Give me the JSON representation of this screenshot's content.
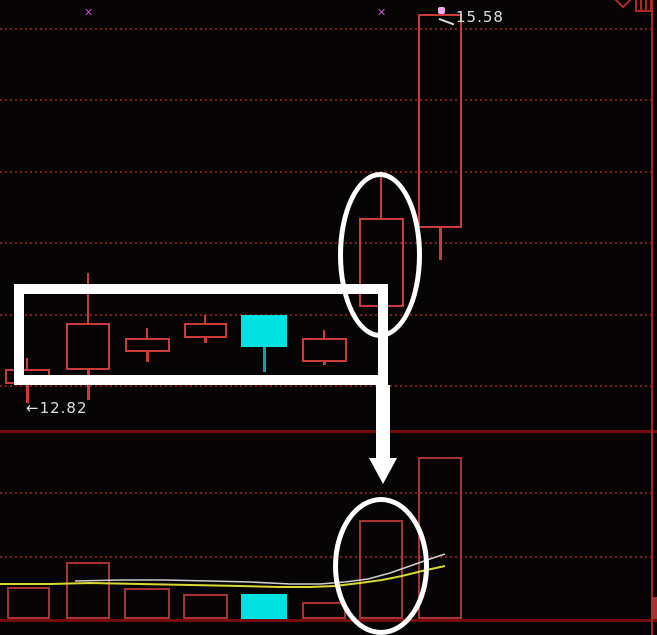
{
  "window": {
    "width": 657,
    "height": 635
  },
  "colors": {
    "background": "#060404",
    "candle_red": "#cd3a3a",
    "volume_red": "#a83232",
    "cyan": "#00e2e2",
    "cyan_wick": "#00a8a8",
    "gridline": "#7c1e1e",
    "divider": "#740c0c",
    "border": "#a82222",
    "ma_yellow": "#d8d835",
    "ma_white": "#cfcfcf",
    "annotation_white": "#ffffff",
    "marker_magenta": "#c94fc9",
    "marker_dot": "#e9aee9",
    "label_text": "#dedede"
  },
  "labels": {
    "high_price": "15.58",
    "low_arrow": "←",
    "low_price": "12.82"
  },
  "header": {
    "icons": [
      {
        "name": "diamond-icon"
      },
      {
        "name": "panel-icon"
      }
    ]
  },
  "chart_data": {
    "type": "candlestick_with_volume",
    "title": "",
    "annotated_high": 15.58,
    "annotated_low": 12.82,
    "panes": [
      "price",
      "volume"
    ],
    "grid": "dotted-horizontal",
    "gridlines_price_y": [
      28,
      99,
      171,
      242,
      314,
      385
    ],
    "gridlines_volume_y": [
      492,
      556
    ],
    "divider_y": 430,
    "baseline_y": 619,
    "right_border_x": 651,
    "candles": [
      {
        "x": 5,
        "w": 45,
        "body_top": 369,
        "body_bot": 384,
        "wick_top": 358,
        "wick_bot": 403,
        "fill": "hollow"
      },
      {
        "x": 66,
        "w": 44,
        "body_top": 323,
        "body_bot": 370,
        "wick_top": 273,
        "wick_bot": 400,
        "fill": "hollow"
      },
      {
        "x": 125,
        "w": 45,
        "body_top": 338,
        "body_bot": 352,
        "wick_top": 328,
        "wick_bot": 362,
        "fill": "hollow"
      },
      {
        "x": 184,
        "w": 43,
        "body_top": 323,
        "body_bot": 338,
        "wick_top": 315,
        "wick_bot": 343,
        "fill": "hollow"
      },
      {
        "x": 241,
        "w": 46,
        "body_top": 315,
        "body_bot": 347,
        "wick_top": 315,
        "wick_bot": 372,
        "fill": "cyan"
      },
      {
        "x": 302,
        "w": 45,
        "body_top": 338,
        "body_bot": 362,
        "wick_top": 330,
        "wick_bot": 365,
        "fill": "hollow"
      },
      {
        "x": 359,
        "w": 45,
        "body_top": 218,
        "body_bot": 307,
        "wick_top": 173,
        "wick_bot": 307,
        "fill": "hollow"
      },
      {
        "x": 418,
        "w": 44,
        "body_top": 14,
        "body_bot": 228,
        "wick_top": 14,
        "wick_bot": 260,
        "fill": "hollow"
      }
    ],
    "volume_bars": [
      {
        "x": 7,
        "w": 43,
        "top": 587,
        "fill": "hollow"
      },
      {
        "x": 66,
        "w": 44,
        "top": 562,
        "fill": "hollow"
      },
      {
        "x": 124,
        "w": 46,
        "top": 588,
        "fill": "hollow"
      },
      {
        "x": 183,
        "w": 45,
        "top": 594,
        "fill": "hollow"
      },
      {
        "x": 241,
        "w": 46,
        "top": 594,
        "fill": "cyan"
      },
      {
        "x": 302,
        "w": 44,
        "top": 602,
        "fill": "hollow"
      },
      {
        "x": 359,
        "w": 44,
        "top": 520,
        "fill": "hollow"
      },
      {
        "x": 418,
        "w": 44,
        "top": 457,
        "fill": "hollow"
      },
      {
        "x": 651,
        "w": 6,
        "top": 597,
        "fill": "solid"
      }
    ],
    "ma_lines": [
      {
        "name": "ma-yellow",
        "color_key": "ma_yellow",
        "width": 2,
        "points": [
          [
            0,
            584
          ],
          [
            50,
            584
          ],
          [
            90,
            583
          ],
          [
            140,
            584
          ],
          [
            190,
            585
          ],
          [
            240,
            586
          ],
          [
            280,
            587
          ],
          [
            310,
            587
          ],
          [
            335,
            586
          ],
          [
            360,
            583
          ],
          [
            382,
            580
          ],
          [
            402,
            576
          ],
          [
            422,
            571
          ],
          [
            445,
            566
          ]
        ]
      },
      {
        "name": "ma-white",
        "color_key": "ma_white",
        "width": 1.6,
        "points": [
          [
            75,
            581
          ],
          [
            120,
            580
          ],
          [
            165,
            580
          ],
          [
            210,
            581
          ],
          [
            250,
            582
          ],
          [
            290,
            584
          ],
          [
            320,
            584
          ],
          [
            345,
            582
          ],
          [
            368,
            579
          ],
          [
            390,
            573
          ],
          [
            410,
            566
          ],
          [
            430,
            559
          ],
          [
            445,
            554
          ]
        ]
      }
    ],
    "markers": [
      {
        "x": 89,
        "y": 13,
        "type": "x",
        "glyph": "✕"
      },
      {
        "x": 382,
        "y": 13,
        "type": "x",
        "glyph": "✕"
      },
      {
        "x": 441,
        "y": 10,
        "type": "dot"
      }
    ],
    "annotations": {
      "rectangle": {
        "x": 14,
        "y": 284,
        "w": 374,
        "h": 101,
        "stroke": 10
      },
      "ellipse_top": {
        "cx": 380,
        "cy": 255,
        "rx": 42,
        "ry": 83,
        "stroke": 5
      },
      "ellipse_bottom": {
        "cx": 381,
        "cy": 566,
        "rx": 48,
        "ry": 69,
        "stroke": 5
      },
      "arrow": {
        "shaft_x": 376,
        "shaft_w": 14,
        "from_y": 385,
        "to_y": 458,
        "head_half_w": 14,
        "head_h": 26
      }
    }
  }
}
